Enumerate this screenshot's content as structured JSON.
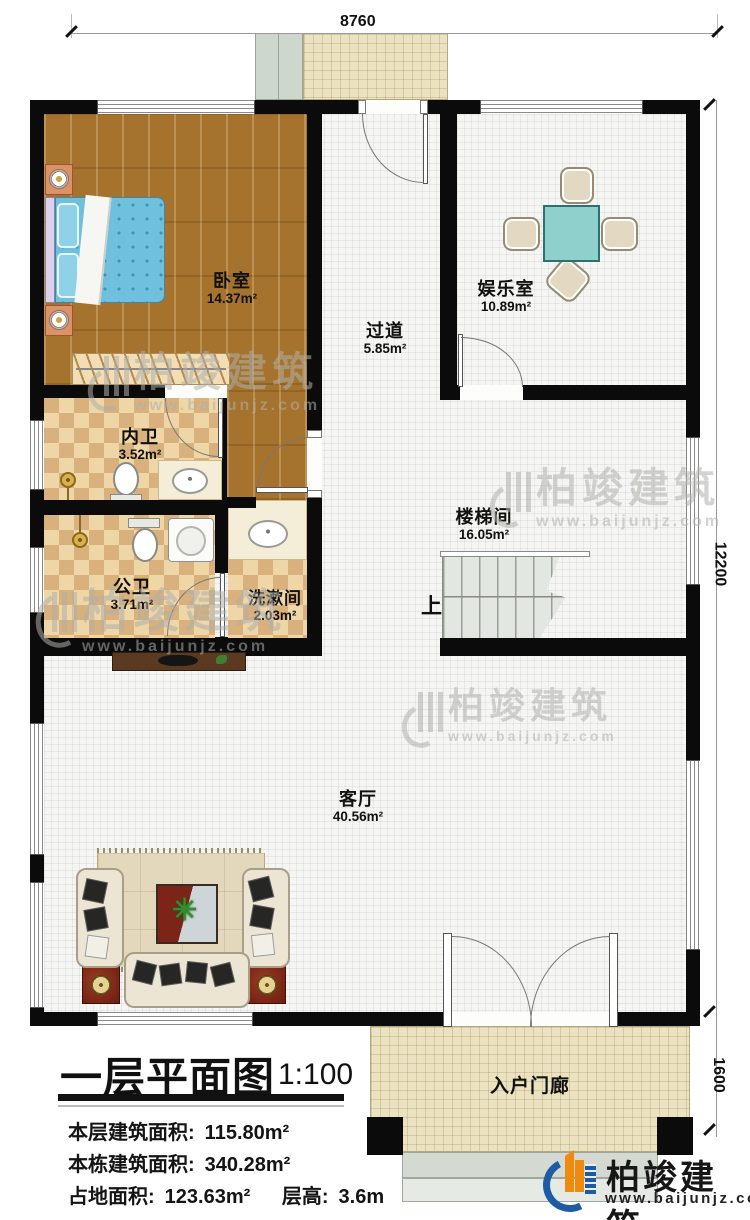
{
  "dimensions": {
    "top": "8760",
    "right_main": "12200",
    "right_porch": "1600"
  },
  "rooms": {
    "bedroom": {
      "name": "卧室",
      "area": "14.37m²"
    },
    "corridor": {
      "name": "过道",
      "area": "5.85m²"
    },
    "entertainment": {
      "name": "娱乐室",
      "area": "10.89m²"
    },
    "inner_bath": {
      "name": "内卫",
      "area": "3.52m²"
    },
    "stairwell": {
      "name": "楼梯间",
      "area": "16.05m²"
    },
    "public_bath": {
      "name": "公卫",
      "area": "3.71m²"
    },
    "washroom": {
      "name": "洗漱间",
      "area": "2.03m²"
    },
    "living": {
      "name": "客厅",
      "area": "40.56m²"
    },
    "porch": {
      "name": "入户门廊"
    }
  },
  "stairs": {
    "up_label": "上"
  },
  "title_block": {
    "title": "一层平面图",
    "scale": "1:100",
    "floor_area_label": "本层建筑面积:",
    "floor_area_value": "115.80m²",
    "building_area_label": "本栋建筑面积:",
    "building_area_value": "340.28m²",
    "land_area_label": "占地面积:",
    "land_area_value": "123.63m²",
    "height_label": "层高:",
    "height_value": "3.6m"
  },
  "branding": {
    "company": "柏竣建筑",
    "website": "www.baijunjz.com"
  },
  "watermark": {
    "company": "柏竣建筑",
    "website": "www.baijunjz.com"
  }
}
